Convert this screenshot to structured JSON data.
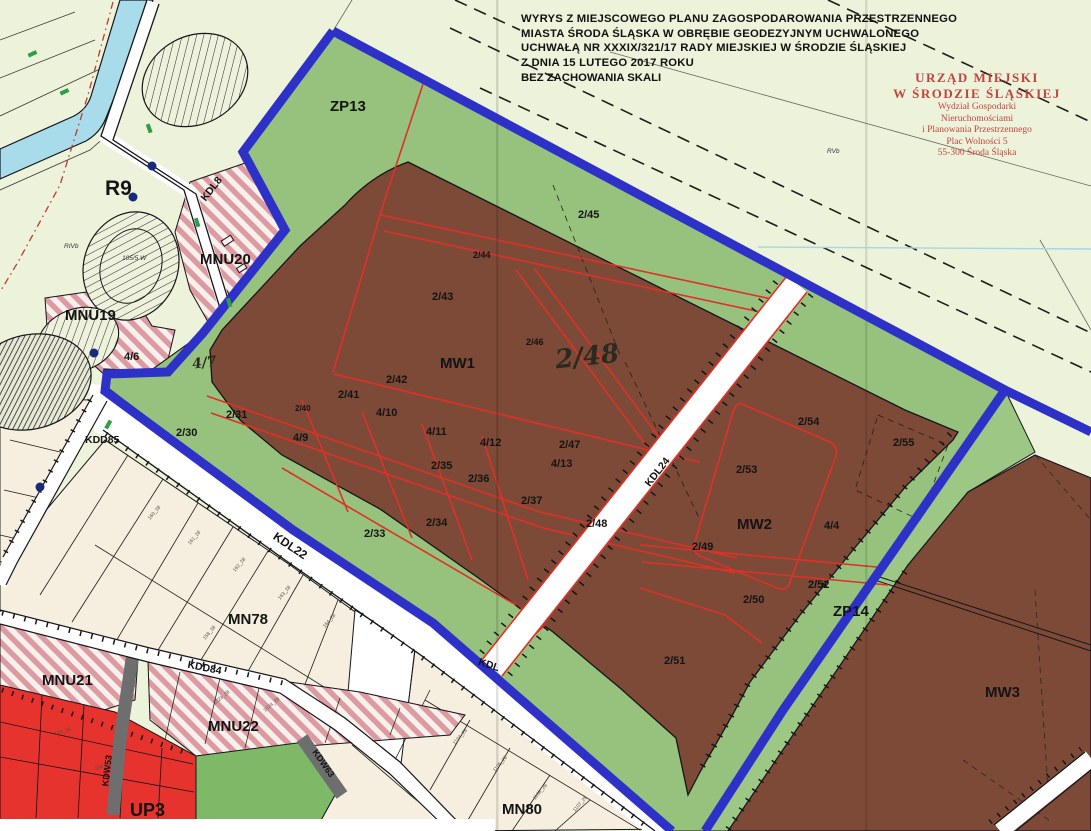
{
  "header": {
    "title_lines": [
      "WYRYS Z MIEJSCOWEGO PLANU ZAGOSPODAROWANIA PRZESTRZENNEGO",
      "MIASTA ŚRODA ŚLĄSKA  W OBRĘBIE GEODEZYJNYM UCHWALONEGO",
      "UCHWAŁĄ NR XXXIX/321/17 RADY MIEJSKIEJ W ŚRODZIE ŚLĄSKIEJ",
      "Z DNIA 15 LUTEGO 2017 ROKU"
    ],
    "scale_note": "BEZ ZACHOWANIA SKALI"
  },
  "stamp": {
    "lines": [
      "URZĄD MIEJSKI",
      "W ŚRODZIE ŚLĄSKIEJ",
      "Wydział Gospodarki",
      "Nieruchomościami",
      "i Planowania Przestrzennego",
      "Plac Wolności 5",
      "55-300 Środa Śląska"
    ]
  },
  "zones": {
    "zp13": "ZP13",
    "zp14": "ZP14",
    "r9": "R9",
    "mw1": "MW1",
    "mw2": "MW2",
    "mw3": "MW3",
    "mn78": "MN78",
    "mn80": "MN80",
    "mnu19": "MNU19",
    "mnu20": "MNU20",
    "mnu21": "MNU21",
    "mnu22": "MNU22",
    "up3": "UP3"
  },
  "roads": {
    "kdl8": "KDL8",
    "kdl22": "KDL22",
    "kdl24": "KDL24",
    "kdd84": "KDD84",
    "kdd85": "KDD85",
    "kdw53": "KDW53",
    "kdw63": "KDW63",
    "kdl_partial": "KDL"
  },
  "parcels": {
    "p2_30": "2/30",
    "p2_31": "2/31",
    "p2_33": "2/33",
    "p2_34": "2/34",
    "p2_35": "2/35",
    "p2_36": "2/36",
    "p2_37": "2/37",
    "p2_40": "2/40",
    "p2_41": "2/41",
    "p2_42": "2/42",
    "p2_43": "2/43",
    "p2_44": "2/44",
    "p2_45": "2/45",
    "p2_46": "2/46",
    "p2_47": "2/47",
    "p2_48": "2/48",
    "p2_49": "2/49",
    "p2_50": "2/50",
    "p2_51": "2/51",
    "p2_52": "2/52",
    "p2_53": "2/53",
    "p2_54": "2/54",
    "p2_55": "2/55",
    "p4_4": "4/4",
    "p4_6": "4/6",
    "p4_9": "4/9",
    "p4_10": "4/10",
    "p4_11": "4/11",
    "p4_12": "4/12",
    "p4_13": "4/13"
  },
  "annotations": {
    "p2_48_big": "2/48",
    "p4_7": "4/7"
  },
  "soil": {
    "rvb": "RVb",
    "rivb": "RIVb",
    "plot105": "105/5 W"
  },
  "micro_labels": [
    "160_28",
    "161_28",
    "162_28",
    "163_28",
    "164_28",
    "158_28",
    "1023_28",
    "1024_28",
    "1104_28",
    "1105_28",
    "1106_28",
    "165_28",
    "166_28",
    "1107_28"
  ],
  "colors": {
    "boundary_blue": "#2e31c8",
    "zone_green": "#97c27e",
    "zone_brown": "#7c4a37",
    "water_blue": "#a8dcea",
    "up_red": "#e6332d",
    "mnu_pink": "#dc9ba1",
    "cream": "#f6eede",
    "stamp_red": "#c0453f",
    "parcel_red": "#e03028"
  }
}
